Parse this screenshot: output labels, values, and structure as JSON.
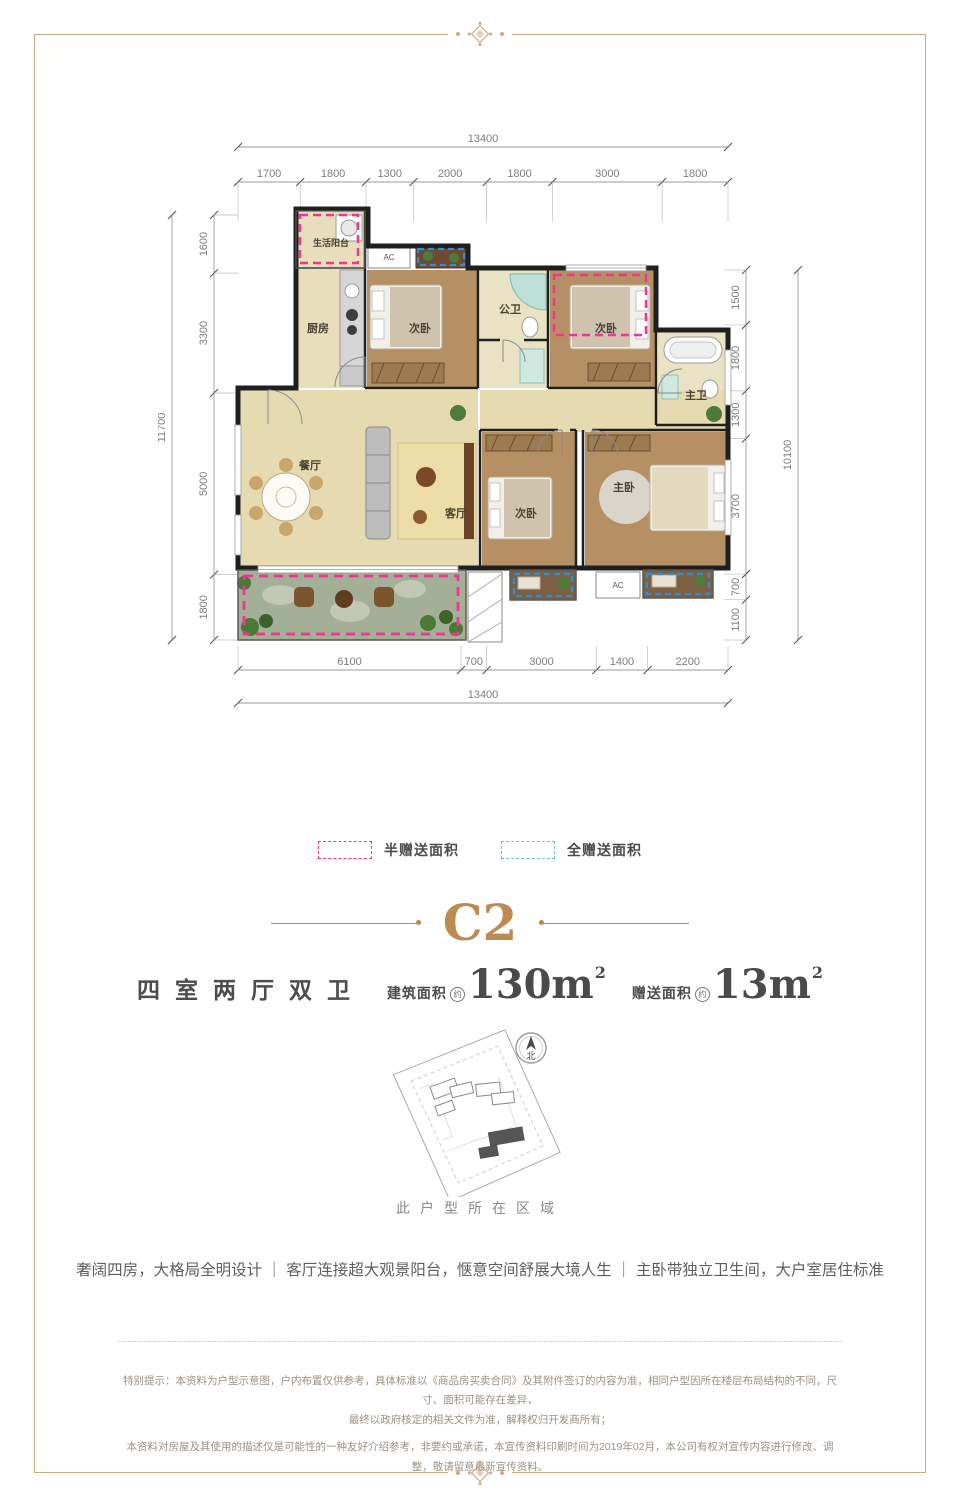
{
  "accent_color": "#bd8a52",
  "floorplan": {
    "dims_top_total": [
      "13400"
    ],
    "dims_top": [
      "1700",
      "1800",
      "1300",
      "2000",
      "1800",
      "3000",
      "1800"
    ],
    "dims_left_total": [
      "11700"
    ],
    "dims_left": [
      "1600",
      "3300",
      "5000",
      "1800"
    ],
    "dims_right": [
      "1500",
      "1800",
      "1300",
      "3700",
      "700",
      "1100"
    ],
    "dims_right_total": [
      "10100"
    ],
    "dims_bottom": [
      "6100",
      "700",
      "3000",
      "1400",
      "2200"
    ],
    "dims_bottom_total": [
      "13400"
    ],
    "rooms": {
      "service_balcony": "生活阳台",
      "kitchen": "厨房",
      "bedroom_a": "次卧",
      "bath_public": "公卫",
      "bedroom_b": "次卧",
      "bath_master": "主卫",
      "dining": "餐厅",
      "living": "客厅",
      "bedroom_c": "次卧",
      "master_bedroom": "主卧",
      "ac": "AC"
    }
  },
  "legend": {
    "half": {
      "label": "半赠送面积",
      "color": "#f0368f"
    },
    "full": {
      "label": "全赠送面积",
      "color": "#6fc3bd"
    }
  },
  "title": {
    "code": "C2"
  },
  "specs": {
    "layout": "四室两厅双卫",
    "area": {
      "label": "建筑面积",
      "approx": "约",
      "value": "130m",
      "sup": "2"
    },
    "gift": {
      "label": "赠送面积",
      "approx": "约",
      "value": "13m",
      "sup": "2"
    }
  },
  "siteplan": {
    "compass_label": "北",
    "caption": "此户型所在区域"
  },
  "tagline": "奢阔四房，大格局全明设计 ｜ 客厅连接超大观景阳台，惬意空间舒展大境人生 ｜ 主卧带独立卫生间，大户室居住标准",
  "disclaimer": {
    "line1": "特别提示：本资料为户型示意图，户内布置仅供参考，具体标准以《商品房买卖合同》及其附件签订的内容为准，相同户型因所在楼层布局结构的不同，尺寸、面积可能存在差异，",
    "line2": "最终以政府核定的相关文件为准，解释权归开发商所有；",
    "line3": "本资料对房屋及其使用的描述仅是可能性的一种友好介绍参考，非要约或承诺，本宣传资料印刷时间为2019年02月，本公司有权对宣传内容进行修改、调整，敬请留意最新宣传资料。"
  }
}
